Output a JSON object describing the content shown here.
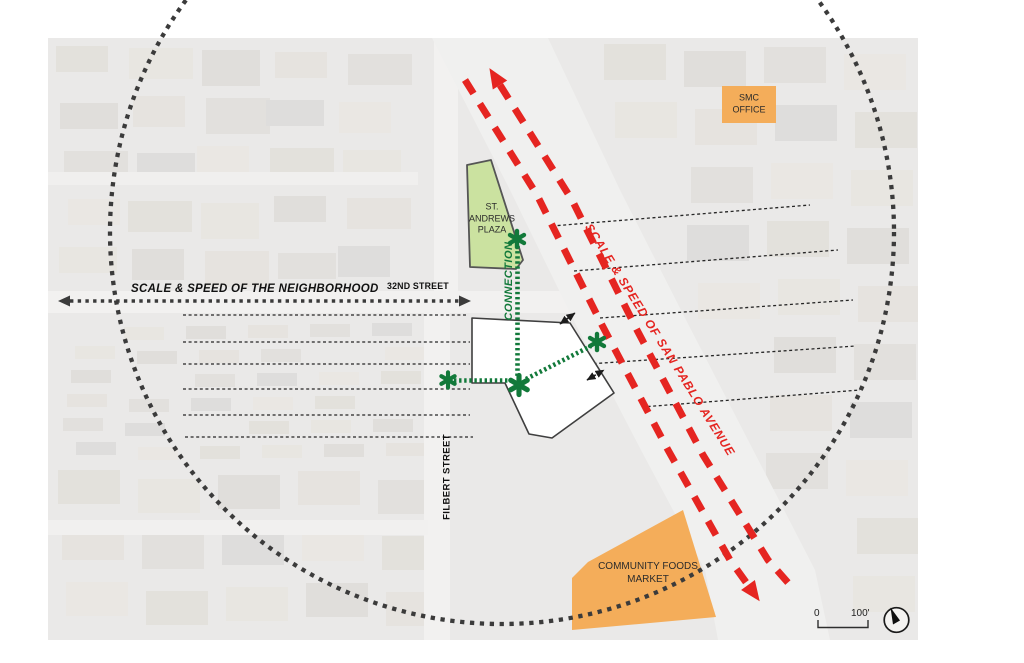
{
  "diagram": {
    "labels": {
      "neighborhood_axis": "SCALE & SPEED OF THE NEIGHBORHOOD",
      "street_32nd": "32ND STREET",
      "san_pablo_axis": "SCALE & SPEED OF SAN PABLO AVENUE",
      "connection": "CONNECTION",
      "filbert_street": "FILBERT STREET",
      "st_andrews_plaza": "ST.\nANDREWS\nPLAZA",
      "smc_office": "SMC\nOFFICE",
      "community_foods_market": "COMMUNITY FOODS\nMARKET"
    },
    "scale_bar": {
      "zero": "0",
      "hundred": "100'"
    },
    "colors": {
      "avenue_red": "#e52521",
      "connection_green": "#12793a",
      "plaza_green": "#cbe2a0",
      "landmark_orange": "#f4ad5a",
      "annotation_gray": "#3b3b3b"
    },
    "icons": {
      "north": "north-arrow-icon",
      "site_marker": "asterisk-icon"
    }
  }
}
